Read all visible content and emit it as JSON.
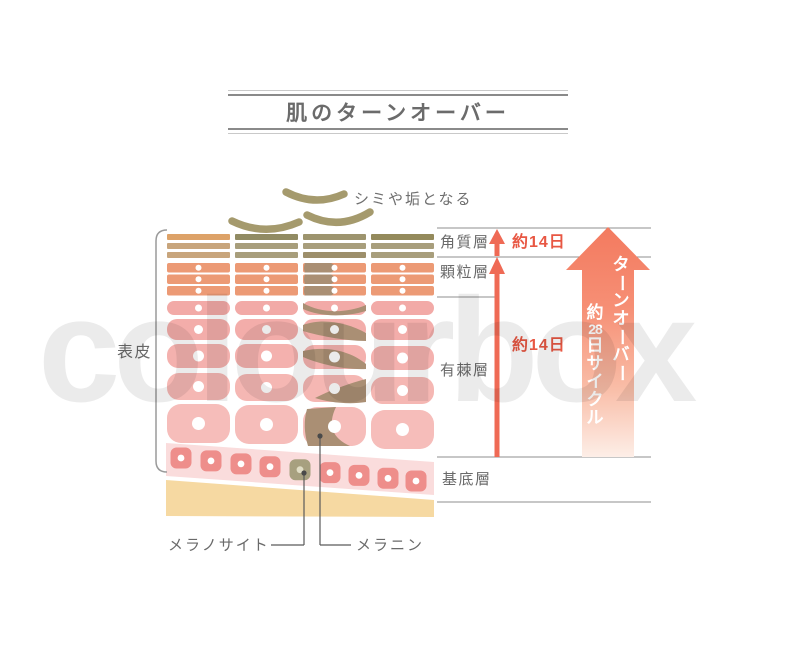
{
  "title": "肌のターンオーバー",
  "watermark": "colourbox",
  "labels": {
    "flake_note": "シミや垢となる",
    "epidermis": "表皮",
    "stratum_corneum": "角質層",
    "granular_layer": "顆粒層",
    "spinous_layer": "有棘層",
    "basal_layer": "基底層",
    "melanocyte": "メラノサイト",
    "melanin": "メラニン"
  },
  "durations": {
    "corneum_duration": "約14日",
    "epidermis_duration": "約14日"
  },
  "turnover_arrow": {
    "line1": "ターンオーバー",
    "line2": "約28日サイクル"
  },
  "colors": {
    "title_gray": "#6b6b6b",
    "label_gray": "#6a6a6a",
    "line_gray": "#8f8f8f",
    "bracket_gray": "#9a9a9a",
    "connector_gray": "#5a5a5a",
    "red_text": "#e85743",
    "accent_red": "#ef6a55",
    "flake_khaki": "#a59a6d",
    "corneum_tan": "#dda268",
    "corneum_tan2": "#c8a57c",
    "corneum_khaki": "#a89e7c",
    "corneum_khaki_dark": "#948a5c",
    "granular_salmon": "#ec9a75",
    "melanin_brown": "#aa8f74",
    "spinous_pink": "#f3adaa",
    "spinous_pink_light": "#f6bdba",
    "basal_cell_pink": "#ee8e8b",
    "basal_band_pink": "#fadcdc",
    "melanocyte_olive": "#a7a07f",
    "melanocyte_dot": "#e0ddc5",
    "dermis_cream": "#f6d9a2",
    "arrow_gradient_top": "#f37a5f",
    "arrow_gradient_mid": "#f68f75",
    "arrow_gradient_low": "#f9bda7",
    "arrow_gradient_bottom": "#fdeee7"
  }
}
